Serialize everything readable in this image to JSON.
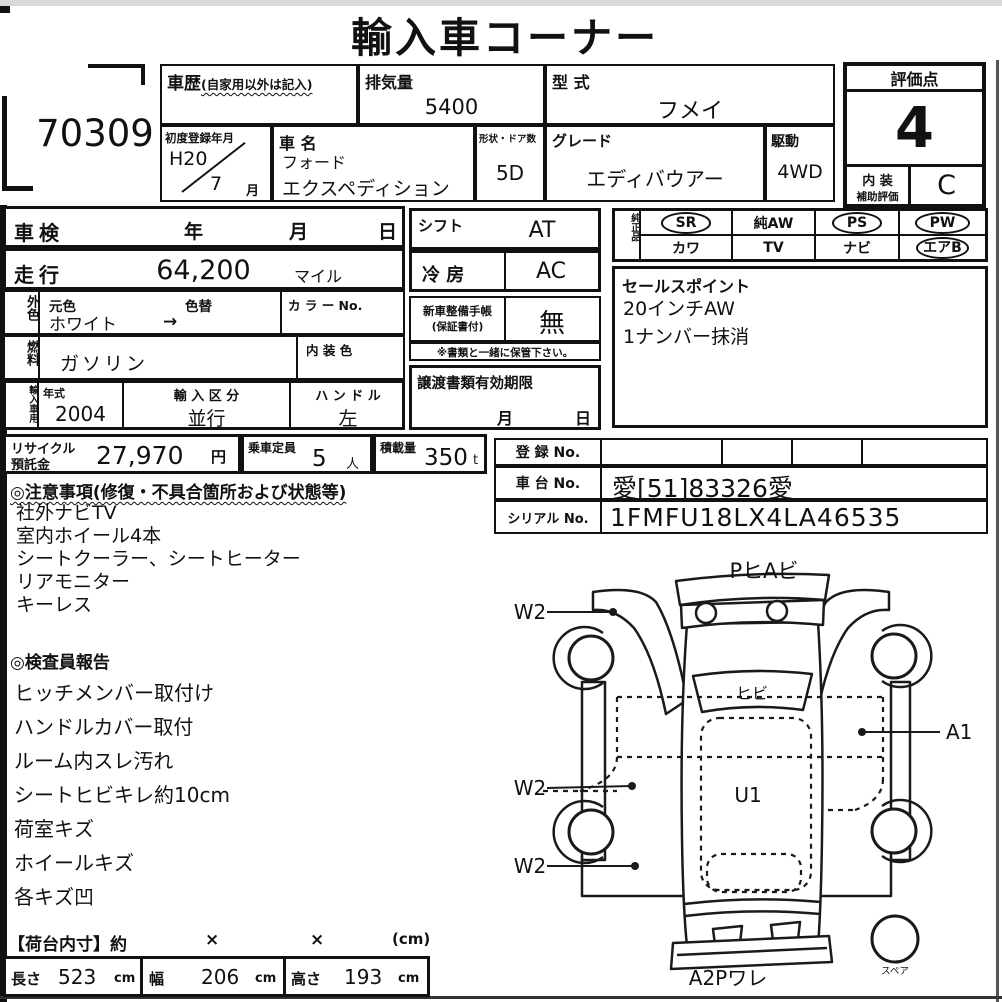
{
  "page": {
    "title": "輸入車コーナー",
    "lot_number": "70309"
  },
  "top": {
    "history_label": "車歴",
    "history_note": "(自家用以外は記入)",
    "displacement_label": "排気量",
    "displacement": "5400",
    "model_code_label": "型 式",
    "model_code": "フメイ",
    "first_reg_label": "初度登録年月",
    "first_reg_year": "H20",
    "first_reg_month": "7",
    "month_suffix": "月",
    "name_label": "車 名",
    "maker": "フォード",
    "model": "エクスペディション",
    "doors_label": "形状・ドア数",
    "doors": "5D",
    "grade_label": "グレード",
    "grade": "エディバウアー",
    "drive_label": "駆動",
    "drive": "4WD"
  },
  "rating": {
    "score_label": "評価点",
    "score": "4",
    "interior_label_top": "内 装",
    "interior_label_bottom": "補助評価",
    "interior_grade": "C"
  },
  "shaken": {
    "label": "車検",
    "year": "年",
    "month": "月",
    "day": "日"
  },
  "mileage": {
    "label": "走行",
    "value": "64,200",
    "unit": "マイル"
  },
  "exterior": {
    "label": "外色",
    "orig_label": "元色",
    "repaint_label": "色替",
    "color": "ホワイト",
    "arrow": "→",
    "color_no_label": "カ ラ ー No."
  },
  "fuel": {
    "label": "燃料",
    "value": "ガソリン",
    "interior_color_label": "内 装 色"
  },
  "import": {
    "label": "輸入車用",
    "year_label": "年式",
    "year": "2004",
    "class_label": "輸 入 区 分",
    "class_value": "並行",
    "handle_label": "ハ ン ド ル",
    "handle": "左"
  },
  "shift": {
    "label": "シフト",
    "value": "AT"
  },
  "aircon": {
    "label": "冷 房",
    "value": "AC"
  },
  "service_book": {
    "label_1": "新車整備手帳",
    "label_2": "(保証書付)",
    "value": "無",
    "note": "※書類と一緒に保管下さい。"
  },
  "transfer": {
    "label": "譲渡書類有効期限",
    "month": "月",
    "day": "日"
  },
  "equipment": {
    "label": "純正品",
    "row1": [
      {
        "label": "SR",
        "circled": true
      },
      {
        "label": "純AW",
        "circled": false
      },
      {
        "label": "PS",
        "circled": true
      },
      {
        "label": "PW",
        "circled": true
      }
    ],
    "row2": [
      {
        "label": "カワ",
        "circled": false
      },
      {
        "label": "TV",
        "circled": false
      },
      {
        "label": "ナビ",
        "circled": false
      },
      {
        "label": "エアB",
        "circled": true
      }
    ]
  },
  "sales_points": {
    "label": "セールスポイント",
    "items": [
      "20インチAW",
      "1ナンバー抹消"
    ]
  },
  "recycle": {
    "label_1": "リサイクル",
    "label_2": "預託金",
    "value": "27,970",
    "unit": "円"
  },
  "capacity": {
    "label": "乗車定員",
    "value": "5",
    "unit": "人"
  },
  "load": {
    "label": "積載量",
    "value": "350",
    "unit": "t"
  },
  "registration": {
    "reg_label": "登 録 No.",
    "chassis_label": "車 台 No.",
    "chassis_no": "愛[51]83326愛",
    "serial_label": "シリアル No.",
    "serial_no": "1FMFU18LX4LA46535"
  },
  "notes": {
    "header": "◎注意事項(修復・不具合箇所および状態等)",
    "items": [
      "社外ナビTV",
      "室内ホイール4本",
      "シートクーラー、シートヒーター",
      "リアモニター",
      "キーレス"
    ]
  },
  "report": {
    "header": "◎検査員報告",
    "items": [
      "ヒッチメンバー取付け",
      "ハンドルカバー取付",
      "ルーム内スレ汚れ",
      "シートヒビキレ約10cm",
      "荷室キズ",
      "ホイールキズ",
      "各キズ凹"
    ]
  },
  "cargo": {
    "header": "【荷台内寸】約",
    "x1": "×",
    "x2": "×",
    "unit_note": "(cm)",
    "length_label": "長さ",
    "length": "523",
    "width_label": "幅",
    "width": "206",
    "height_label": "高さ",
    "height": "193",
    "cm": "cm"
  },
  "diagram": {
    "top_label": "PヒAビ",
    "w2_upper": "W2",
    "w2_middle": "W2",
    "w2_lower": "W2",
    "windshield_label": "ヒビ",
    "a1_label": "A1",
    "u1_label": "U1",
    "bottom_label": "A2Pワレ",
    "spare_label": "スペア"
  }
}
